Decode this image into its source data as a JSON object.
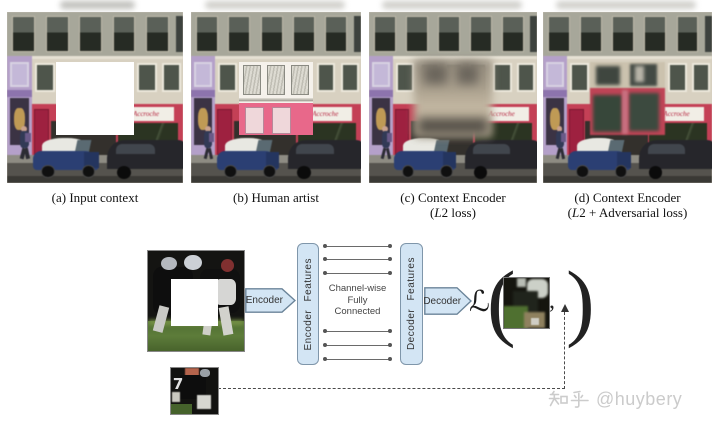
{
  "page": {
    "background": "#ffffff",
    "watermark_logo_text": "知乎",
    "watermark_handle": "@huybery"
  },
  "panels": {
    "a": {
      "caption": "(a) Input context"
    },
    "b": {
      "caption": "(b) Human artist"
    },
    "c": {
      "caption_line1": "(c) Context Encoder",
      "loss_open": "(",
      "loss_var": "L",
      "loss_rest": "2 loss)"
    },
    "d": {
      "caption_line1": "(d) Context Encoder",
      "loss_open": "(",
      "loss_var": "L",
      "loss_rest": "2 + Adversarial loss)"
    }
  },
  "street": {
    "sign_text": "Accroche"
  },
  "diagram": {
    "encoder_label": "Encoder",
    "encoder_features_label": "Encoder Features",
    "channel_lines": [
      "Channel-wise",
      "Fully",
      "Connected"
    ],
    "decoder_features_label": "Decoder Features",
    "decoder_label": "Decoder",
    "loss_symbol": "ℒ",
    "paren_open": "(",
    "comma": ",",
    "paren_close": ")",
    "target_jersey_number": "7",
    "colors": {
      "box_fill": "#d3e5f4",
      "box_border": "#7f96aa",
      "connector_line": "#666666",
      "dashed_line": "#4a4a4a",
      "label_text": "#333333",
      "storefront_red": "#c44056",
      "shop_purple": "#b4a0c9"
    }
  }
}
